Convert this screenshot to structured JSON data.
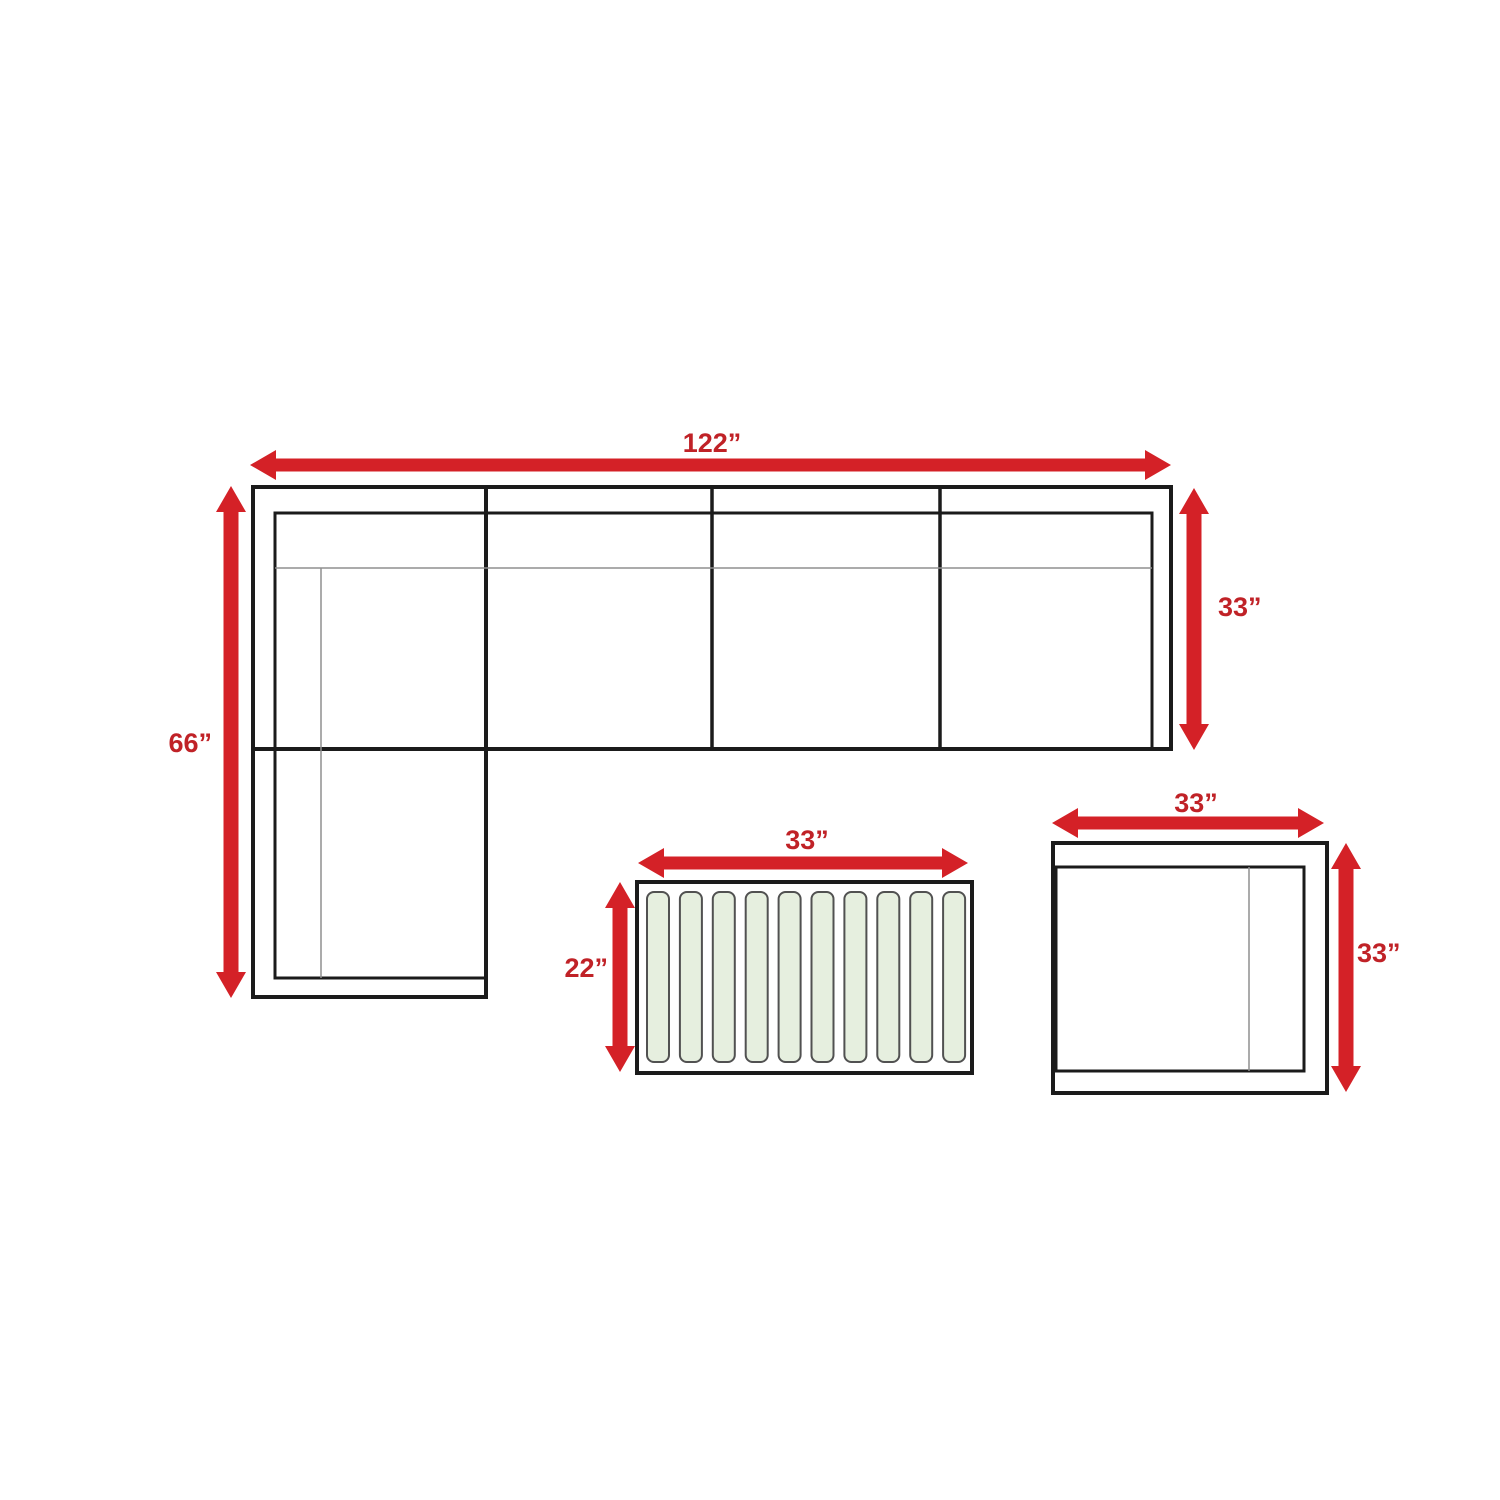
{
  "diagram": {
    "background": "#ffffff",
    "accent_red": "#d42127",
    "label_red": "#c02227",
    "outline_black": "#1b1b1b",
    "thin_gray": "#8f8f8f",
    "sofa": {
      "width_label": "122”",
      "chaise_length_label": "66”",
      "depth_label": "33”",
      "seat_sections": 4
    },
    "coffee_table": {
      "width_label": "33”",
      "depth_label": "22”",
      "slat_count": 10,
      "slat_fill": "#e6efdf",
      "slat_border": "#515151"
    },
    "side_table": {
      "width_label": "33”",
      "depth_label": "33”"
    }
  }
}
